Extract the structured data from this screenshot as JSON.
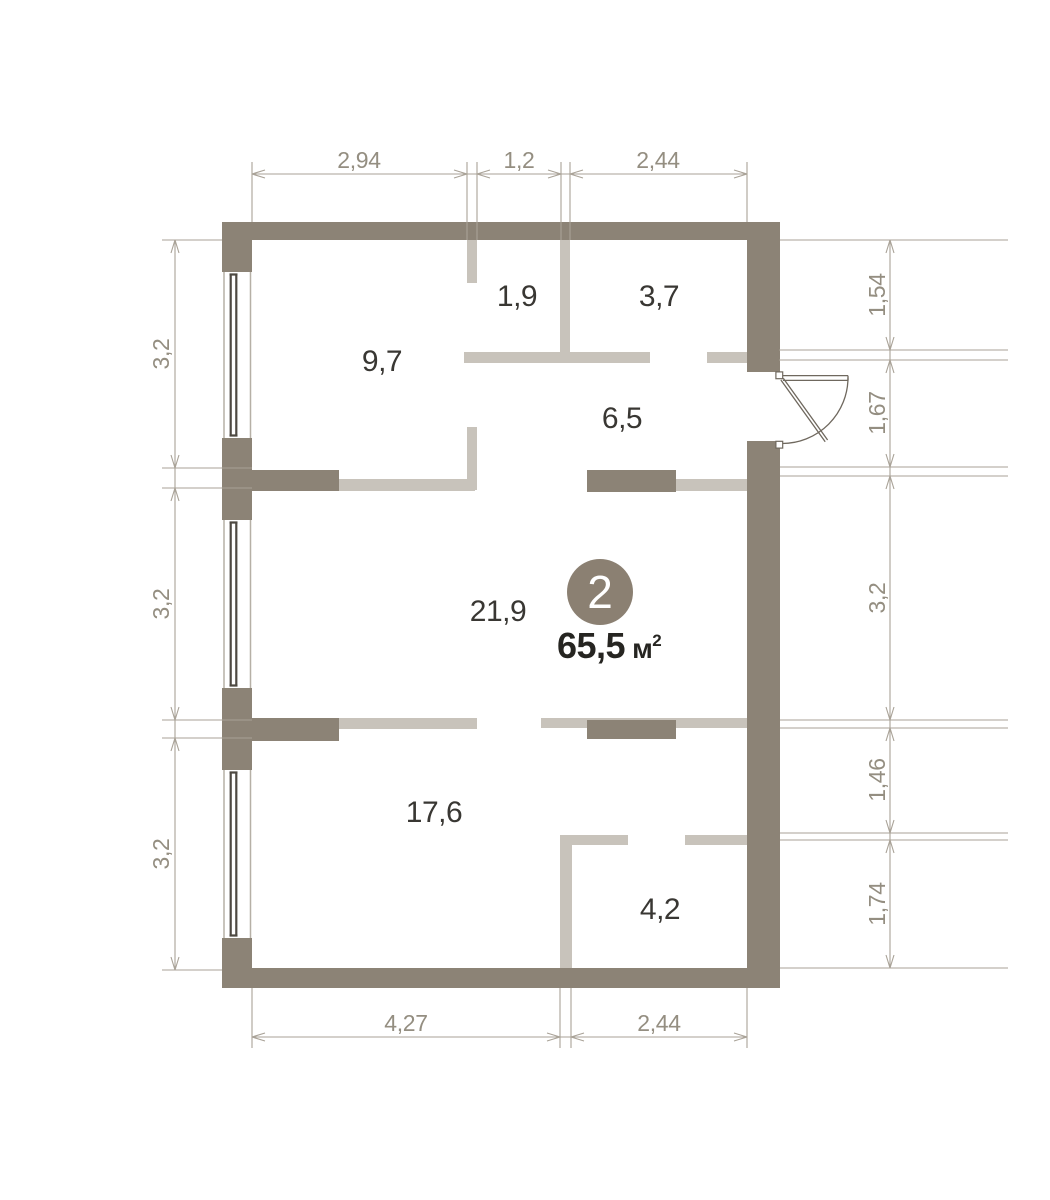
{
  "plan": {
    "unit": {
      "number": "2",
      "area_value": "65,5",
      "area_unit": "м",
      "area_sup": "2"
    },
    "rooms": [
      {
        "id": "room-9-7",
        "label": "9,7"
      },
      {
        "id": "room-1-9",
        "label": "1,9"
      },
      {
        "id": "room-3-7",
        "label": "3,7"
      },
      {
        "id": "room-6-5",
        "label": "6,5"
      },
      {
        "id": "room-21-9",
        "label": "21,9"
      },
      {
        "id": "room-17-6",
        "label": "17,6"
      },
      {
        "id": "room-4-2",
        "label": "4,2"
      }
    ],
    "dimensions": {
      "top": [
        "2,94",
        "1,2",
        "2,44"
      ],
      "bottom": [
        "4,27",
        "2,44"
      ],
      "left": [
        "3,2",
        "3,2",
        "3,2"
      ],
      "right": [
        "1,54",
        "1,67",
        "3,2",
        "1,46",
        "1,74"
      ]
    },
    "colors": {
      "wall": "#8c8376",
      "partition": "#c8c3bb",
      "dimension_line": "#a9a297",
      "dimension_text": "#948e81",
      "room_text": "#393733",
      "area_text": "#262521",
      "badge_fill": "#8b8072",
      "badge_text": "#ffffff",
      "window_glass": "#4e4942",
      "door": "#6f685e",
      "background": "#ffffff"
    }
  }
}
